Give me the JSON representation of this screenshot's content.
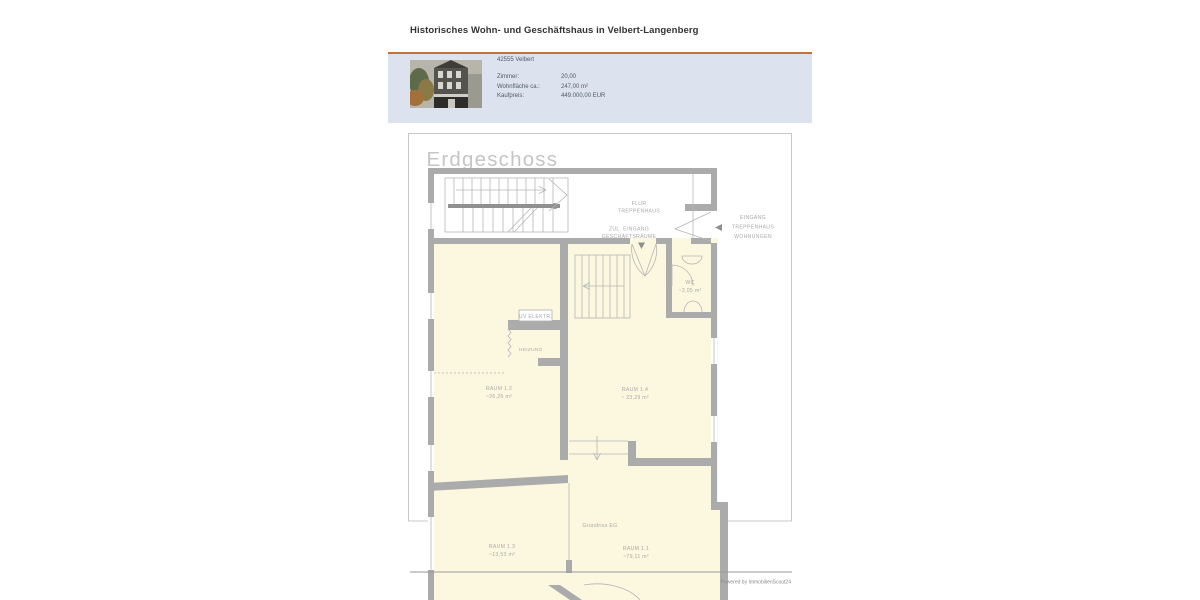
{
  "page": {
    "title": "Historisches Wohn- und Geschäftshaus in Velbert-Langenberg"
  },
  "info_box": {
    "location": "42555 Velbert",
    "rows": [
      {
        "label": "Zimmer:",
        "value": "20,00"
      },
      {
        "label": "Wohnfläche ca.:",
        "value": "247,00 m²"
      },
      {
        "label": "Kaufpreis:",
        "value": "449.000,00 EUR"
      }
    ]
  },
  "floorplan": {
    "title": "Erdgeschoss",
    "caption": "Grundriss EG",
    "credit": "Powered by ImmobilienScout24",
    "labels": {
      "flur1": "FLUR",
      "flur2": "TREPPENHAUS",
      "zul1": "ZUL. EINGANG",
      "zul2": "GESCHÄFTSRÄUME",
      "ein1": "EINGANG",
      "ein2": "TREPPENHAUS",
      "ein3": "WOHNUNGEN",
      "wc": "WC",
      "wc_area": "~2,05 m²",
      "uv": "UV ELEKTR.",
      "heizung": "HEIZUNG",
      "r12": "RAUM 1.2",
      "r12a": "~26,26 m²",
      "r14": "RAUM 1.4",
      "r14a": "~ 23,29 m²",
      "r13": "RAUM 1.3",
      "r13a": "~13,53 m²",
      "r11": "RAUM 1.1",
      "r11a": "~79,11 m²"
    }
  },
  "colors": {
    "accent": "#c4713b",
    "info_box_bg": "#dce3ef",
    "room_fill": "#fbf8df",
    "wall_gray": "#ababab",
    "plan_text": "#a9a9a9"
  }
}
